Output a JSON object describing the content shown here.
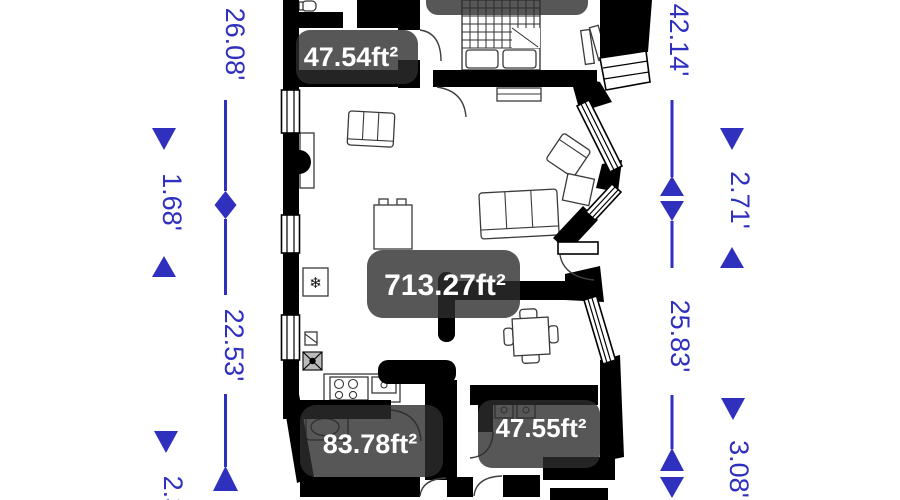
{
  "floorplan": {
    "rooms": [
      {
        "id": "room-top-left",
        "area_label": "47.54ft²"
      },
      {
        "id": "room-living",
        "area_label": "713.27ft²"
      },
      {
        "id": "room-bath",
        "area_label": "83.78ft²"
      },
      {
        "id": "room-bottom-right",
        "area_label": "47.55ft²"
      }
    ],
    "dimensions_left": [
      {
        "value": "26.08'"
      },
      {
        "value": "1.68'"
      },
      {
        "value": "22.53'"
      },
      {
        "value": "2.3'"
      }
    ],
    "dimensions_right": [
      {
        "value": "42.14'"
      },
      {
        "value": "2.71'"
      },
      {
        "value": "25.83'"
      },
      {
        "value": "3.08'"
      }
    ],
    "icons": {
      "freezer": "❄"
    },
    "colors": {
      "dimension_blue": "#3030bf",
      "label_background": "rgba(45,45,45,0.8)",
      "label_text": "#ffffff",
      "wall": "#000000"
    }
  }
}
